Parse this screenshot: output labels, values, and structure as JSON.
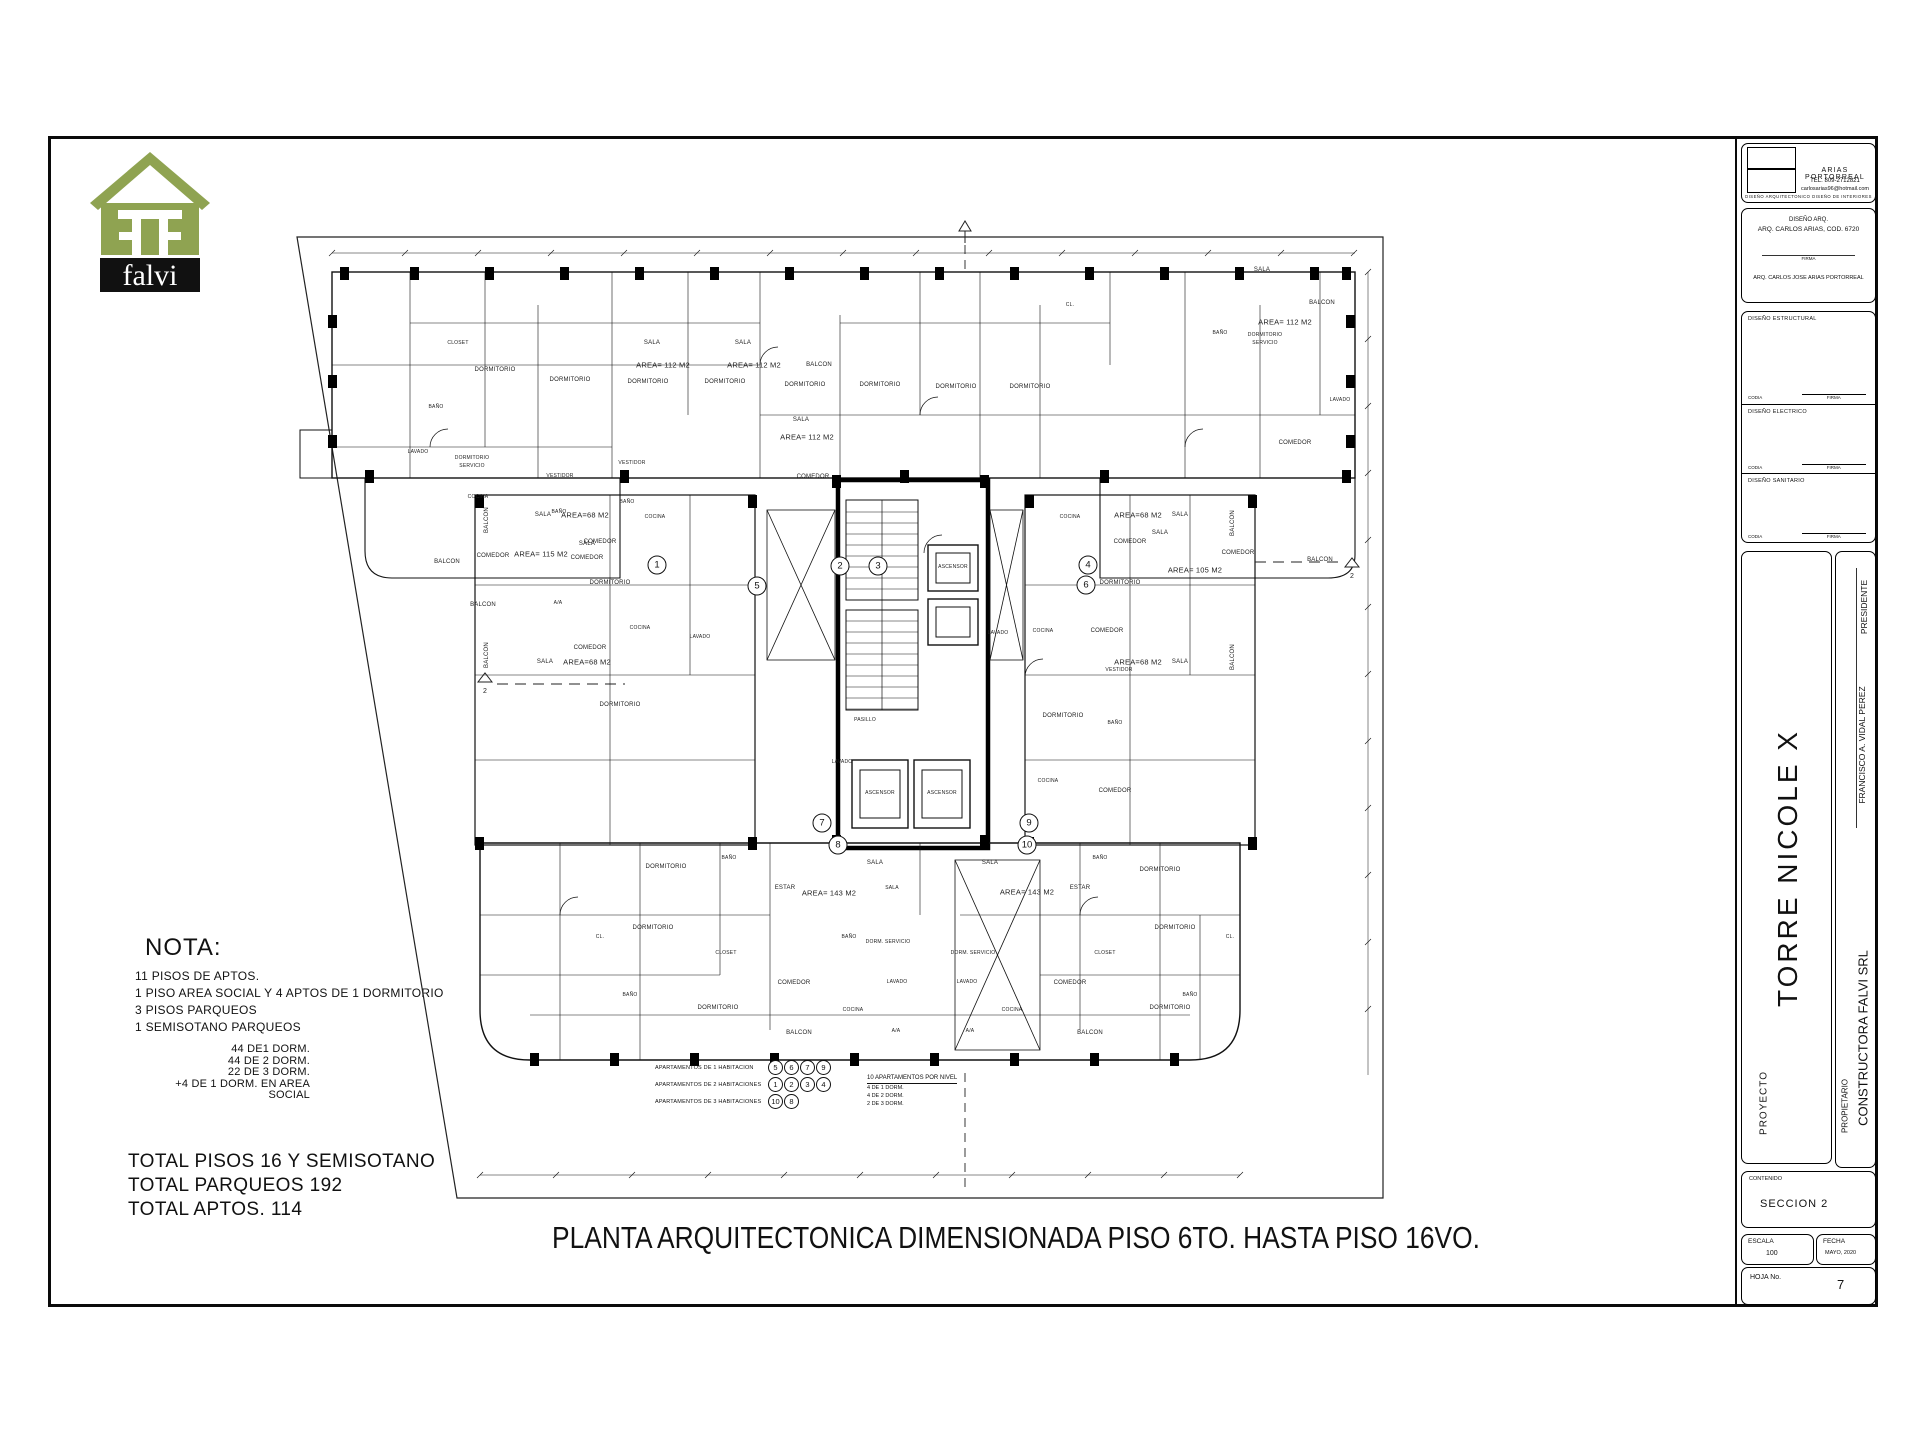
{
  "sheet": {
    "logo_brand": "falvi",
    "main_title": "PLANTA ARQUITECTONICA DIMENSIONADA PISO 6TO.  HASTA PISO 16VO.",
    "nota": {
      "heading": "NOTA:",
      "lines": [
        "11 PISOS DE APTOS.",
        "1 PISO AREA SOCIAL Y 4 APTOS DE 1 DORMITORIO",
        "3 PISOS PARQUEOS",
        "1 SEMISOTANO PARQUEOS"
      ],
      "sub_lines": [
        "44 DE1 DORM.",
        "44 DE 2 DORM.",
        "22 DE 3 DORM.",
        "+4 DE 1 DORM. EN AREA SOCIAL"
      ]
    },
    "totals": [
      "TOTAL  PISOS 16 Y SEMISOTANO",
      "TOTAL  PARQUEOS  192",
      "TOTAL APTOS. 114"
    ]
  },
  "colors": {
    "logo_green": "#8fa351",
    "ink": "#111111"
  },
  "title_block": {
    "firm": {
      "name": "ARIAS PORTORREAL",
      "tel": "TEL.  809-2712821",
      "email": "carlosarias96@hotmail.com",
      "tagline": "DISEÑO ARQUITECTONICO   DISEÑO DE INTERIORES"
    },
    "diseno_arq": {
      "label": "DISEÑO ARQ.",
      "name": "ARQ. CARLOS ARIAS, COD. 6720",
      "firma_label": "FIRMA",
      "signer": "ARQ. CARLOS JOSE  ARIAS PORTORREAL"
    },
    "sections": [
      {
        "label": "DISEÑO ESTRUCTURAL",
        "codia": "CODIA",
        "firma": "FIRMA"
      },
      {
        "label": "DISEÑO ELECTRICO",
        "codia": "CODIA",
        "firma": "FIRMA"
      },
      {
        "label": "DISEÑO SANITARIO",
        "codia": "CODIA",
        "firma": "FIRMA"
      }
    ],
    "proyecto": {
      "label": "PROYECTO",
      "value": "TORRE NICOLE  X"
    },
    "owner_sign": {
      "name": "FRANCISCO A. VIDAL PEREZ",
      "title": "PRESIDENTE"
    },
    "propietario": {
      "label": "PROPIETARIO",
      "value": "CONSTRUCTORA FALVI SRL"
    },
    "contenido": {
      "label": "CONTENIDO",
      "value": "SECCION  2"
    },
    "escala": {
      "label": "ESCALA",
      "value": "100"
    },
    "fecha": {
      "label": "FECHA",
      "value": "MAYO, 2020"
    },
    "hoja": {
      "label": "HOJA No.",
      "value": "7"
    }
  },
  "plan": {
    "section_marker": "2",
    "unit_markers": [
      {
        "n": "1",
        "x": 377,
        "y": 350
      },
      {
        "n": "2",
        "x": 560,
        "y": 351
      },
      {
        "n": "3",
        "x": 598,
        "y": 351
      },
      {
        "n": "4",
        "x": 808,
        "y": 350
      },
      {
        "n": "5",
        "x": 477,
        "y": 371
      },
      {
        "n": "6",
        "x": 806,
        "y": 370
      },
      {
        "n": "7",
        "x": 542,
        "y": 608
      },
      {
        "n": "8",
        "x": 558,
        "y": 630
      },
      {
        "n": "9",
        "x": 749,
        "y": 608
      },
      {
        "n": "10",
        "x": 747,
        "y": 630
      }
    ],
    "legend": {
      "rows": [
        {
          "label": "APARTAMENTOS DE 1 HABITACION",
          "units": [
            "5",
            "6",
            "7",
            "9"
          ]
        },
        {
          "label": "APARTAMENTOS DE 2 HABITACIONES",
          "units": [
            "1",
            "2",
            "3",
            "4"
          ]
        },
        {
          "label": "APARTAMENTOS DE 3 HABITACIONES",
          "units": [
            "10",
            "8"
          ]
        }
      ],
      "summary": {
        "title": "10 APARTAMENTOS POR NIVEL",
        "lines": [
          "4 DE 1 DORM.",
          "4 DE 2 DORM.",
          "2 DE 3 DORM."
        ]
      }
    },
    "room_labels": [
      {
        "t": "DORMITORIO",
        "x": 215,
        "y": 155
      },
      {
        "t": "DORMITORIO",
        "x": 290,
        "y": 165
      },
      {
        "t": "DORMITORIO",
        "x": 368,
        "y": 167
      },
      {
        "t": "DORMITORIO",
        "x": 445,
        "y": 167
      },
      {
        "t": "DORMITORIO",
        "x": 525,
        "y": 170
      },
      {
        "t": "DORMITORIO",
        "x": 600,
        "y": 170
      },
      {
        "t": "DORMITORIO",
        "x": 676,
        "y": 172
      },
      {
        "t": "DORMITORIO",
        "x": 750,
        "y": 172
      },
      {
        "t": "CLOSET",
        "x": 178,
        "y": 128,
        "cls": "xs"
      },
      {
        "t": "BAÑO",
        "x": 156,
        "y": 192,
        "cls": "xs"
      },
      {
        "t": "LAVADO",
        "x": 138,
        "y": 237,
        "cls": "xs"
      },
      {
        "t": "DORMITORIO",
        "x": 192,
        "y": 243,
        "cls": "xs"
      },
      {
        "t": "SERVICIO",
        "x": 192,
        "y": 251,
        "cls": "xs"
      },
      {
        "t": "VESTIDOR",
        "x": 280,
        "y": 261,
        "cls": "xs"
      },
      {
        "t": "VESTIDOR",
        "x": 352,
        "y": 248,
        "cls": "xs"
      },
      {
        "t": "COCINA",
        "x": 198,
        "y": 282,
        "cls": "xs"
      },
      {
        "t": "BAÑO",
        "x": 279,
        "y": 297,
        "cls": "xs"
      },
      {
        "t": "BAÑO",
        "x": 347,
        "y": 287,
        "cls": "xs"
      },
      {
        "t": "SALA",
        "x": 372,
        "y": 128
      },
      {
        "t": "AREA= 112 M2",
        "x": 383,
        "y": 150,
        "cls": "md"
      },
      {
        "t": "SALA",
        "x": 463,
        "y": 128
      },
      {
        "t": "AREA= 112 M2",
        "x": 474,
        "y": 150,
        "cls": "md"
      },
      {
        "t": "BALCON",
        "x": 539,
        "y": 150
      },
      {
        "t": "SALA",
        "x": 521,
        "y": 205
      },
      {
        "t": "AREA= 112 M2",
        "x": 527,
        "y": 222,
        "cls": "md"
      },
      {
        "t": "COMEDOR",
        "x": 533,
        "y": 262
      },
      {
        "t": "CL.",
        "x": 790,
        "y": 90,
        "cls": "xs"
      },
      {
        "t": "SALA",
        "x": 982,
        "y": 55
      },
      {
        "t": "AREA= 112 M2",
        "x": 1005,
        "y": 107,
        "cls": "md"
      },
      {
        "t": "BALCON",
        "x": 1042,
        "y": 88
      },
      {
        "t": "DORMITORIO",
        "x": 985,
        "y": 120,
        "cls": "xs"
      },
      {
        "t": "SERVICIO",
        "x": 985,
        "y": 128,
        "cls": "xs"
      },
      {
        "t": "COMEDOR",
        "x": 1015,
        "y": 228
      },
      {
        "t": "LAVADO",
        "x": 1060,
        "y": 185,
        "cls": "xs"
      },
      {
        "t": "BAÑO",
        "x": 940,
        "y": 118,
        "cls": "xs"
      },
      {
        "t": "BALCON",
        "x": 167,
        "y": 347
      },
      {
        "t": "COMEDOR",
        "x": 213,
        "y": 341
      },
      {
        "t": "AREA= 115 M2",
        "x": 261,
        "y": 339,
        "cls": "md"
      },
      {
        "t": "SALA",
        "x": 307,
        "y": 329
      },
      {
        "t": "COMEDOR",
        "x": 307,
        "y": 343
      },
      {
        "t": "BALCON",
        "x": 203,
        "y": 390
      },
      {
        "t": "A/A",
        "x": 278,
        "y": 388,
        "cls": "xs"
      },
      {
        "t": "SALA",
        "x": 880,
        "y": 318
      },
      {
        "t": "COMEDOR",
        "x": 958,
        "y": 338
      },
      {
        "t": "AREA= 105 M2",
        "x": 915,
        "y": 355,
        "cls": "md"
      },
      {
        "t": "BALCON",
        "x": 1040,
        "y": 345
      },
      {
        "t": "BALCON",
        "x": 207,
        "y": 305,
        "cls": "vt"
      },
      {
        "t": "SALA",
        "x": 263,
        "y": 300
      },
      {
        "t": "AREA=68 M2",
        "x": 305,
        "y": 300,
        "cls": "md"
      },
      {
        "t": "COCINA",
        "x": 375,
        "y": 302,
        "cls": "xs"
      },
      {
        "t": "COMEDOR",
        "x": 320,
        "y": 327
      },
      {
        "t": "DORMITORIO",
        "x": 330,
        "y": 368
      },
      {
        "t": "BALCON",
        "x": 207,
        "y": 440,
        "cls": "vt"
      },
      {
        "t": "SALA",
        "x": 265,
        "y": 447
      },
      {
        "t": "AREA=68 M2",
        "x": 307,
        "y": 447,
        "cls": "md"
      },
      {
        "t": "COMEDOR",
        "x": 310,
        "y": 433
      },
      {
        "t": "COCINA",
        "x": 360,
        "y": 413,
        "cls": "xs"
      },
      {
        "t": "LAVADO",
        "x": 420,
        "y": 422,
        "cls": "xs"
      },
      {
        "t": "DORMITORIO",
        "x": 340,
        "y": 490
      },
      {
        "t": "COCINA",
        "x": 790,
        "y": 302,
        "cls": "xs"
      },
      {
        "t": "SALA",
        "x": 900,
        "y": 300
      },
      {
        "t": "AREA=68 M2",
        "x": 858,
        "y": 300,
        "cls": "md"
      },
      {
        "t": "COMEDOR",
        "x": 850,
        "y": 327
      },
      {
        "t": "DORMITORIO",
        "x": 840,
        "y": 368
      },
      {
        "t": "LAVADO",
        "x": 718,
        "y": 418,
        "cls": "xs"
      },
      {
        "t": "COCINA",
        "x": 763,
        "y": 416,
        "cls": "xs"
      },
      {
        "t": "COMEDOR",
        "x": 827,
        "y": 416
      },
      {
        "t": "VESTIDOR",
        "x": 839,
        "y": 455,
        "cls": "xs"
      },
      {
        "t": "DORMITORIO",
        "x": 783,
        "y": 501
      },
      {
        "t": "BAÑO",
        "x": 835,
        "y": 508,
        "cls": "xs"
      },
      {
        "t": "SALA",
        "x": 900,
        "y": 447
      },
      {
        "t": "AREA=68 M2",
        "x": 858,
        "y": 447,
        "cls": "md"
      },
      {
        "t": "COCINA",
        "x": 768,
        "y": 566,
        "cls": "xs"
      },
      {
        "t": "COMEDOR",
        "x": 835,
        "y": 576
      },
      {
        "t": "LAVADO",
        "x": 562,
        "y": 547,
        "cls": "xs"
      },
      {
        "t": "BALCON",
        "x": 953,
        "y": 308,
        "cls": "vt"
      },
      {
        "t": "BALCON",
        "x": 953,
        "y": 442,
        "cls": "vt"
      },
      {
        "t": "ASCENSOR",
        "x": 673,
        "y": 352,
        "cls": "xs"
      },
      {
        "t": "PASILLO",
        "x": 585,
        "y": 505,
        "cls": "xs"
      },
      {
        "t": "ASCENSOR",
        "x": 600,
        "y": 578,
        "cls": "xs"
      },
      {
        "t": "ASCENSOR",
        "x": 662,
        "y": 578,
        "cls": "xs"
      },
      {
        "t": "DORMITORIO",
        "x": 386,
        "y": 652
      },
      {
        "t": "BAÑO",
        "x": 449,
        "y": 643,
        "cls": "xs"
      },
      {
        "t": "ESTAR",
        "x": 505,
        "y": 673
      },
      {
        "t": "AREA= 143 M2",
        "x": 549,
        "y": 678,
        "cls": "md"
      },
      {
        "t": "SALA",
        "x": 595,
        "y": 648
      },
      {
        "t": "SALA",
        "x": 612,
        "y": 673,
        "cls": "xs"
      },
      {
        "t": "DORMITORIO",
        "x": 373,
        "y": 713
      },
      {
        "t": "CL.",
        "x": 320,
        "y": 722,
        "cls": "xs"
      },
      {
        "t": "CLOSET",
        "x": 446,
        "y": 738,
        "cls": "xs"
      },
      {
        "t": "BAÑO",
        "x": 569,
        "y": 722,
        "cls": "xs"
      },
      {
        "t": "DORM. SERVICIO",
        "x": 608,
        "y": 727,
        "cls": "xs"
      },
      {
        "t": "COMEDOR",
        "x": 514,
        "y": 768
      },
      {
        "t": "DORMITORIO",
        "x": 438,
        "y": 793
      },
      {
        "t": "LAVADO",
        "x": 617,
        "y": 767,
        "cls": "xs"
      },
      {
        "t": "COCINA",
        "x": 573,
        "y": 795,
        "cls": "xs"
      },
      {
        "t": "BALCON",
        "x": 519,
        "y": 818
      },
      {
        "t": "A/A",
        "x": 616,
        "y": 816,
        "cls": "xs"
      },
      {
        "t": "BAÑO",
        "x": 350,
        "y": 780,
        "cls": "xs"
      },
      {
        "t": "SALA",
        "x": 710,
        "y": 648
      },
      {
        "t": "AREA= 143 M2",
        "x": 747,
        "y": 677,
        "cls": "md"
      },
      {
        "t": "ESTAR",
        "x": 800,
        "y": 673
      },
      {
        "t": "DORMITORIO",
        "x": 880,
        "y": 655
      },
      {
        "t": "BAÑO",
        "x": 820,
        "y": 643,
        "cls": "xs"
      },
      {
        "t": "DORMITORIO",
        "x": 895,
        "y": 713
      },
      {
        "t": "CLOSET",
        "x": 825,
        "y": 738,
        "cls": "xs"
      },
      {
        "t": "DORM. SERVICIO",
        "x": 693,
        "y": 738,
        "cls": "xs"
      },
      {
        "t": "COMEDOR",
        "x": 790,
        "y": 768
      },
      {
        "t": "DORMITORIO",
        "x": 890,
        "y": 793
      },
      {
        "t": "LAVADO",
        "x": 687,
        "y": 767,
        "cls": "xs"
      },
      {
        "t": "COCINA",
        "x": 732,
        "y": 795,
        "cls": "xs"
      },
      {
        "t": "BALCON",
        "x": 810,
        "y": 818
      },
      {
        "t": "A/A",
        "x": 690,
        "y": 816,
        "cls": "xs"
      },
      {
        "t": "BAÑO",
        "x": 910,
        "y": 780,
        "cls": "xs"
      },
      {
        "t": "CL.",
        "x": 950,
        "y": 722,
        "cls": "xs"
      }
    ]
  }
}
